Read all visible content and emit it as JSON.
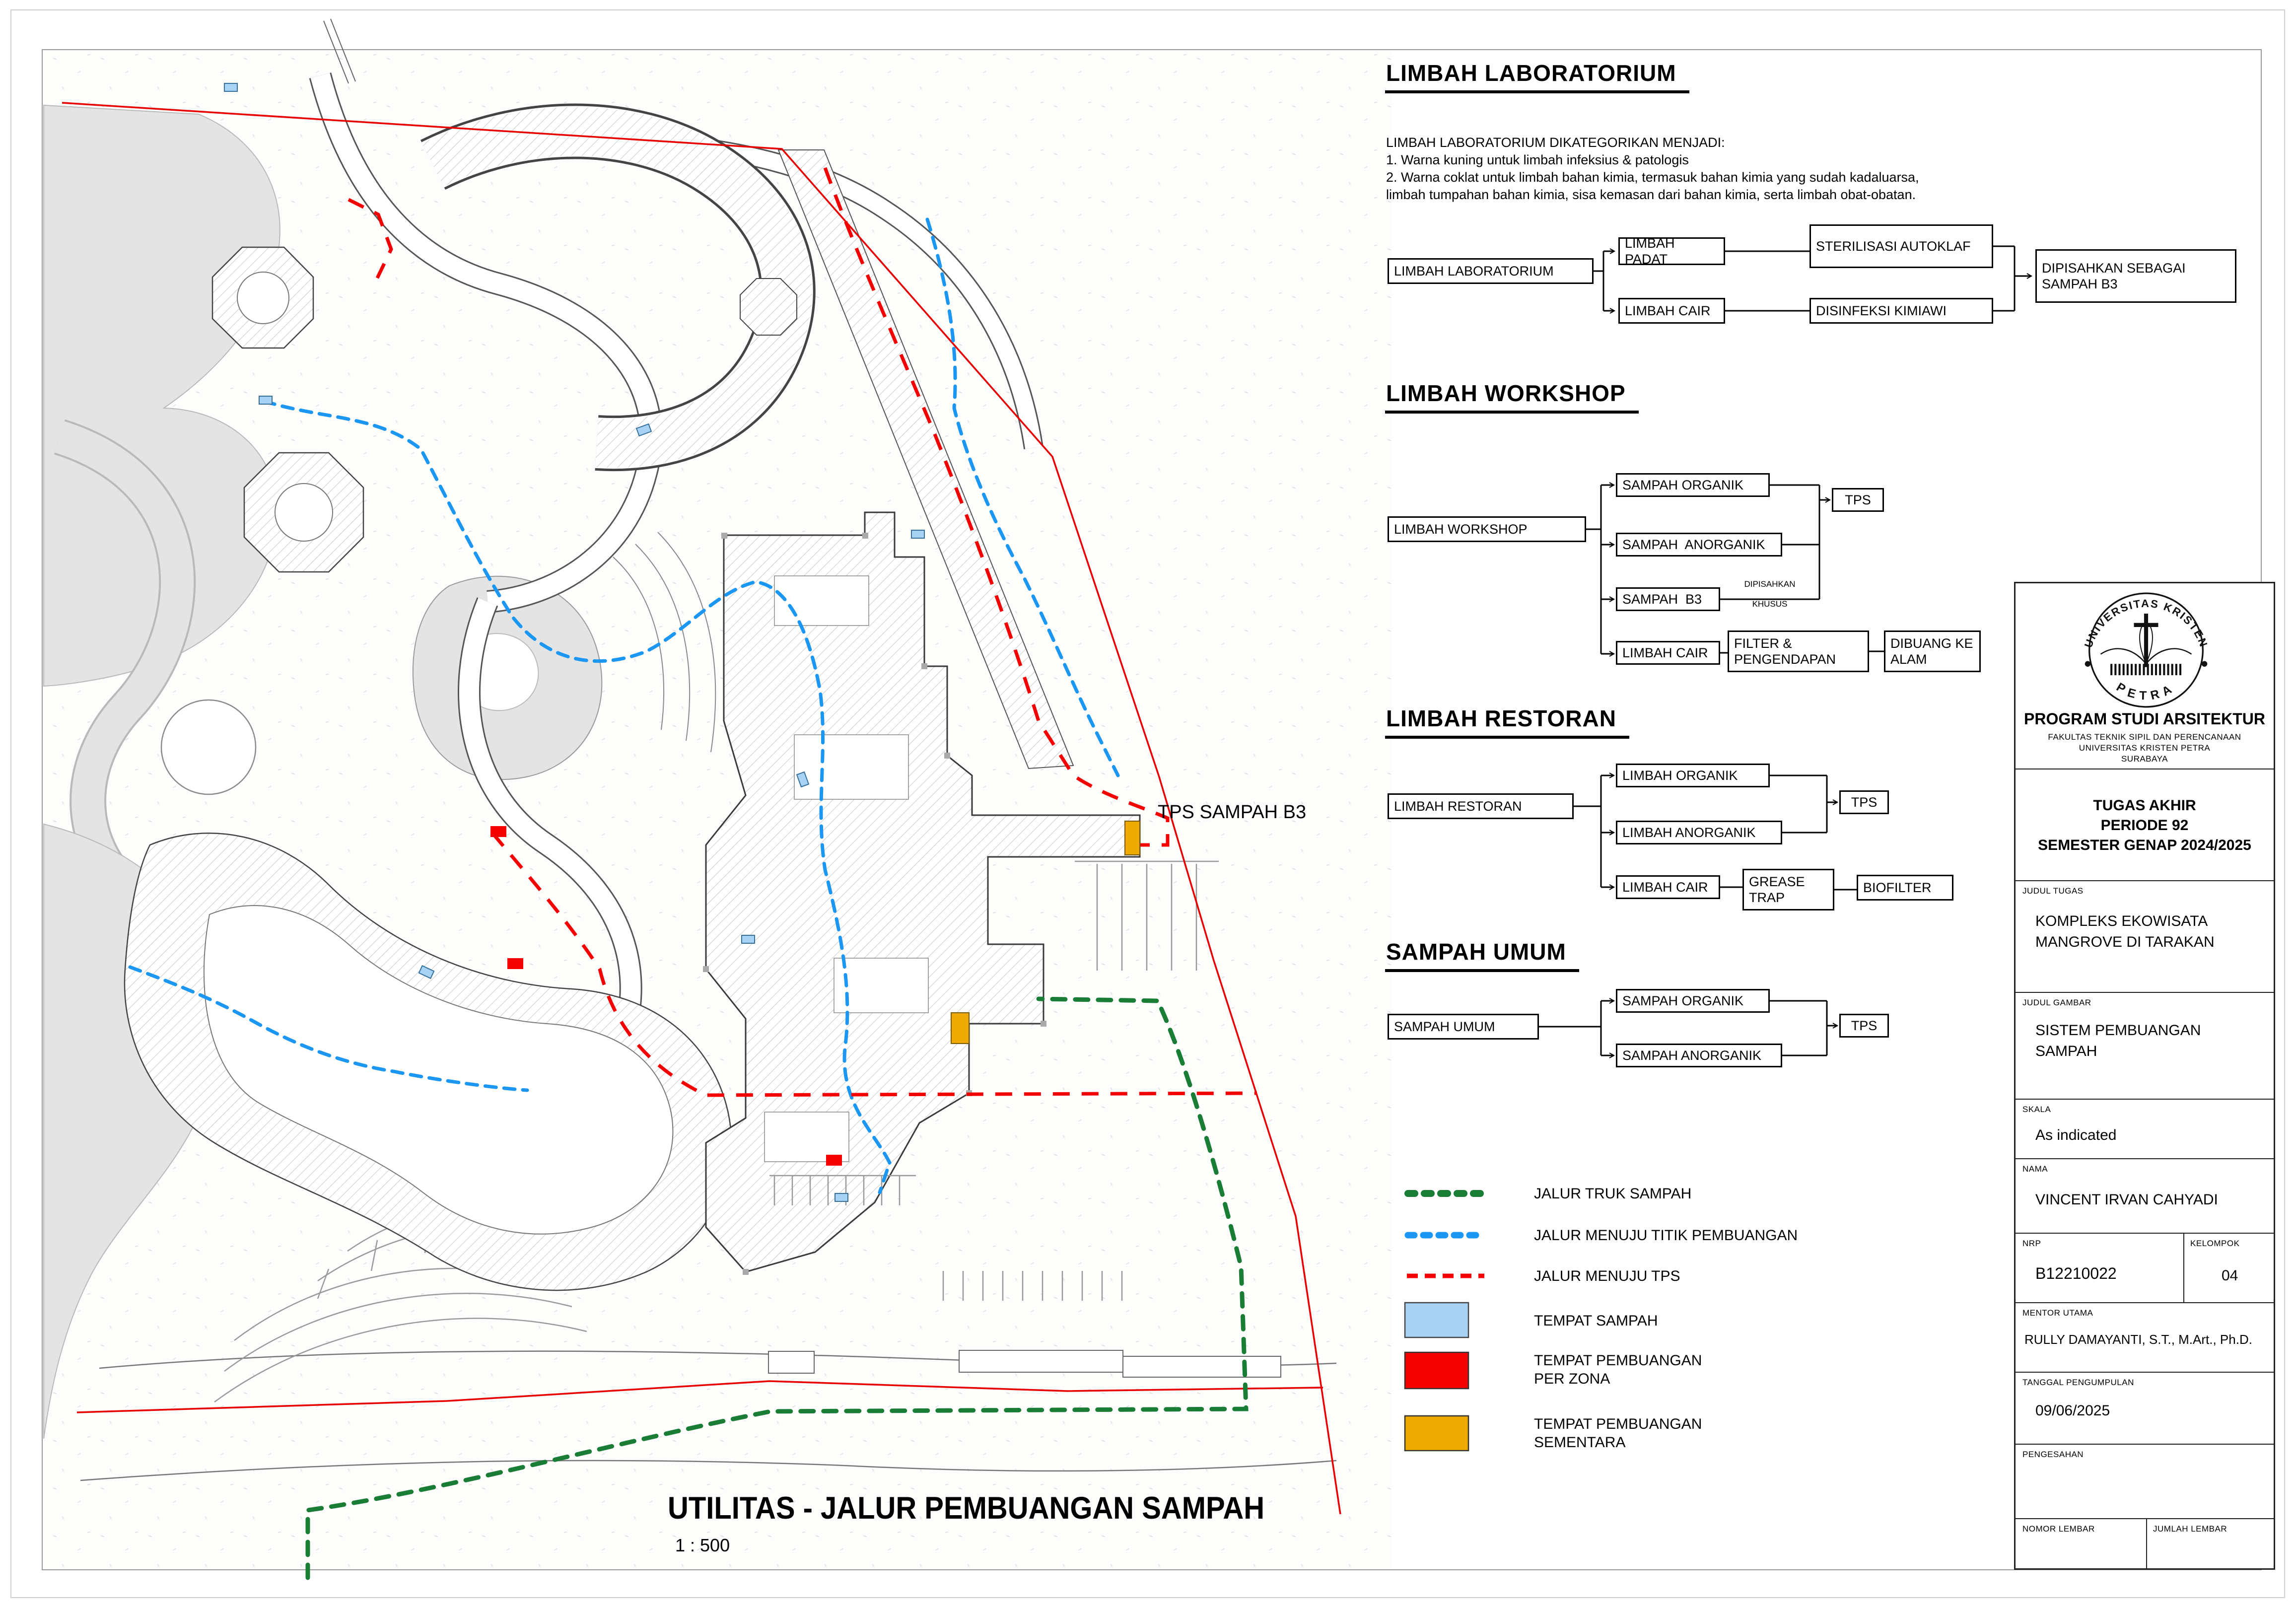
{
  "plan": {
    "tps_label": "TPS SAMPAH B3",
    "title": "UTILITAS - JALUR PEMBUANGAN SAMPAH",
    "scale": "1 : 500",
    "colors": {
      "boundary": "#e80000",
      "route_truck": "#1a7d35",
      "route_titik": "#1b97f3",
      "route_tps": "#f50000",
      "tempat_sampah": "#a9d3f5",
      "tempat_per_zona": "#f50000",
      "tempat_sementara": "#eeaa00"
    }
  },
  "charts": [
    {
      "heading": "LIMBAH LABORATORIUM",
      "description": "LIMBAH LABORATORIUM DIKATEGORIKAN MENJADI:\n1. Warna kuning untuk limbah infeksius & patologis\n2. Warna coklat untuk limbah bahan kimia, termasuk bahan kimia yang sudah kadaluarsa,\nlimbah tumpahan bahan kimia, sisa kemasan dari bahan kimia, serta limbah obat-obatan.",
      "source": "LIMBAH LABORATORIUM",
      "boxes": {
        "padat": "LIMBAH PADAT",
        "cair": "LIMBAH CAIR",
        "sterilisasi": "STERILISASI AUTOKLAF",
        "disinfeksi": "DISINFEKSI KIMIAWI",
        "hasil": "DIPISAHKAN SEBAGAI SAMPAH B3"
      }
    },
    {
      "heading": "LIMBAH WORKSHOP",
      "source": "LIMBAH WORKSHOP",
      "note": "DIPISAHKAN\nKHUSUS",
      "boxes": {
        "organik": "SAMPAH ORGANIK",
        "anorganik": "SAMPAH  ANORGANIK",
        "b3": "SAMPAH  B3",
        "cair": "LIMBAH CAIR",
        "tps": "TPS",
        "filter": "FILTER & PENGENDAPAN",
        "dibuang": "DIBUANG KE ALAM"
      }
    },
    {
      "heading": "LIMBAH RESTORAN",
      "source": "LIMBAH RESTORAN",
      "boxes": {
        "organik": "LIMBAH ORGANIK",
        "anorganik": "LIMBAH ANORGANIK",
        "cair": "LIMBAH CAIR",
        "tps": "TPS",
        "grease": "GREASE TRAP",
        "biofilter": "BIOFILTER"
      }
    },
    {
      "heading": "SAMPAH UMUM",
      "source": "SAMPAH UMUM",
      "boxes": {
        "organik": "SAMPAH ORGANIK",
        "anorganik": "SAMPAH ANORGANIK",
        "tps": "TPS"
      }
    }
  ],
  "legend": {
    "items": [
      {
        "type": "line",
        "color": "#1a7d35",
        "label": "JALUR TRUK SAMPAH"
      },
      {
        "type": "line",
        "color": "#1b97f3",
        "label": "JALUR MENUJU TITIK PEMBUANGAN"
      },
      {
        "type": "line",
        "color": "#f50000",
        "label": "JALUR MENUJU TPS"
      },
      {
        "type": "rect",
        "color": "#a9d3f5",
        "label": "TEMPAT SAMPAH"
      },
      {
        "type": "rect",
        "color": "#f50000",
        "label": "TEMPAT PEMBUANGAN\nPER ZONA"
      },
      {
        "type": "rect",
        "color": "#eeaa00",
        "label": "TEMPAT PEMBUANGAN\nSEMENTARA"
      }
    ]
  },
  "titleblock": {
    "logo_top": "UNIVERSITAS KRISTEN",
    "logo_bottom": "PETRA",
    "program": "PROGRAM STUDI ARSITEKTUR",
    "faculty": "FAKULTAS TEKNIK SIPIL DAN PERENCANAAN",
    "university": "UNIVERSITAS KRISTEN PETRA",
    "city": "SURABAYA",
    "project": "TUGAS AKHIR\nPERIODE 92\nSEMESTER GENAP 2024/2025",
    "judul_tugas_label": "JUDUL TUGAS",
    "judul_tugas": "KOMPLEKS EKOWISATA\nMANGROVE DI TARAKAN",
    "judul_gambar_label": "JUDUL GAMBAR",
    "judul_gambar": "SISTEM PEMBUANGAN\nSAMPAH",
    "skala_label": "SKALA",
    "skala": "As indicated",
    "nama_label": "NAMA",
    "nama": "VINCENT IRVAN CAHYADI",
    "nrp_label": "NRP",
    "nrp": "B12210022",
    "kelompok_label": "KELOMPOK",
    "kelompok": "04",
    "mentor_label": "MENTOR UTAMA",
    "mentor": "RULLY DAMAYANTI, S.T., M.Art., Ph.D.",
    "tanggal_label": "TANGGAL PENGUMPULAN",
    "tanggal": "09/06/2025",
    "pengesahan_label": "PENGESAHAN",
    "nomor_label": "NOMOR LEMBAR",
    "jumlah_label": "JUMLAH LEMBAR"
  }
}
